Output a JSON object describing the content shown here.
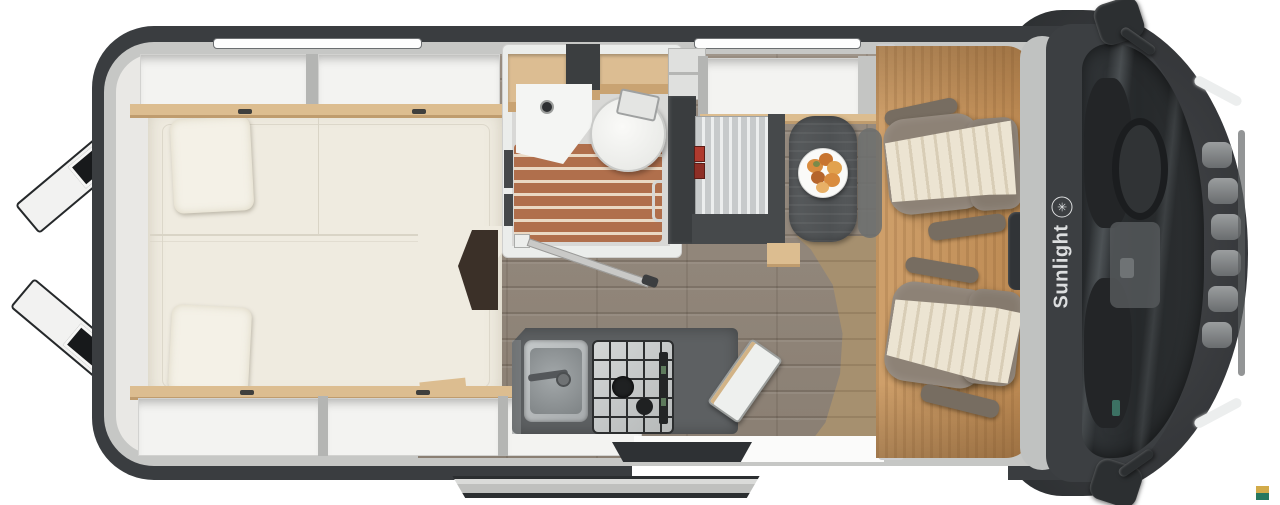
{
  "brand": {
    "name": "Sunlight",
    "icon_glyph": "✳"
  },
  "watermark": {
    "top": "#d2ab4a",
    "bottom": "#27785f",
    "top_style": "background:#d2ab4a",
    "bottom_style": "background:#27785f"
  },
  "colors": {
    "hull_dark": "#3a3d40",
    "rim_light": "#c6c7c5",
    "interior_wall": "#e9e8e5",
    "mattress_cream": "#efebe0",
    "cabinet_wood_trim": "#dcbd90",
    "shower_slats": "#b06f4c",
    "kitchen_counter": "#5d6062",
    "bench_stripes": "#c7cacb",
    "seatbelt_red": "#b03a2e",
    "cab_floor_amber": "#c39460",
    "living_floor": "#91867a",
    "seat_taupe": "#8d8276",
    "seat_runner_cream": "#ece4d2",
    "glass_dark": "#292c2e",
    "logo_text_color": "#dcdedf"
  }
}
